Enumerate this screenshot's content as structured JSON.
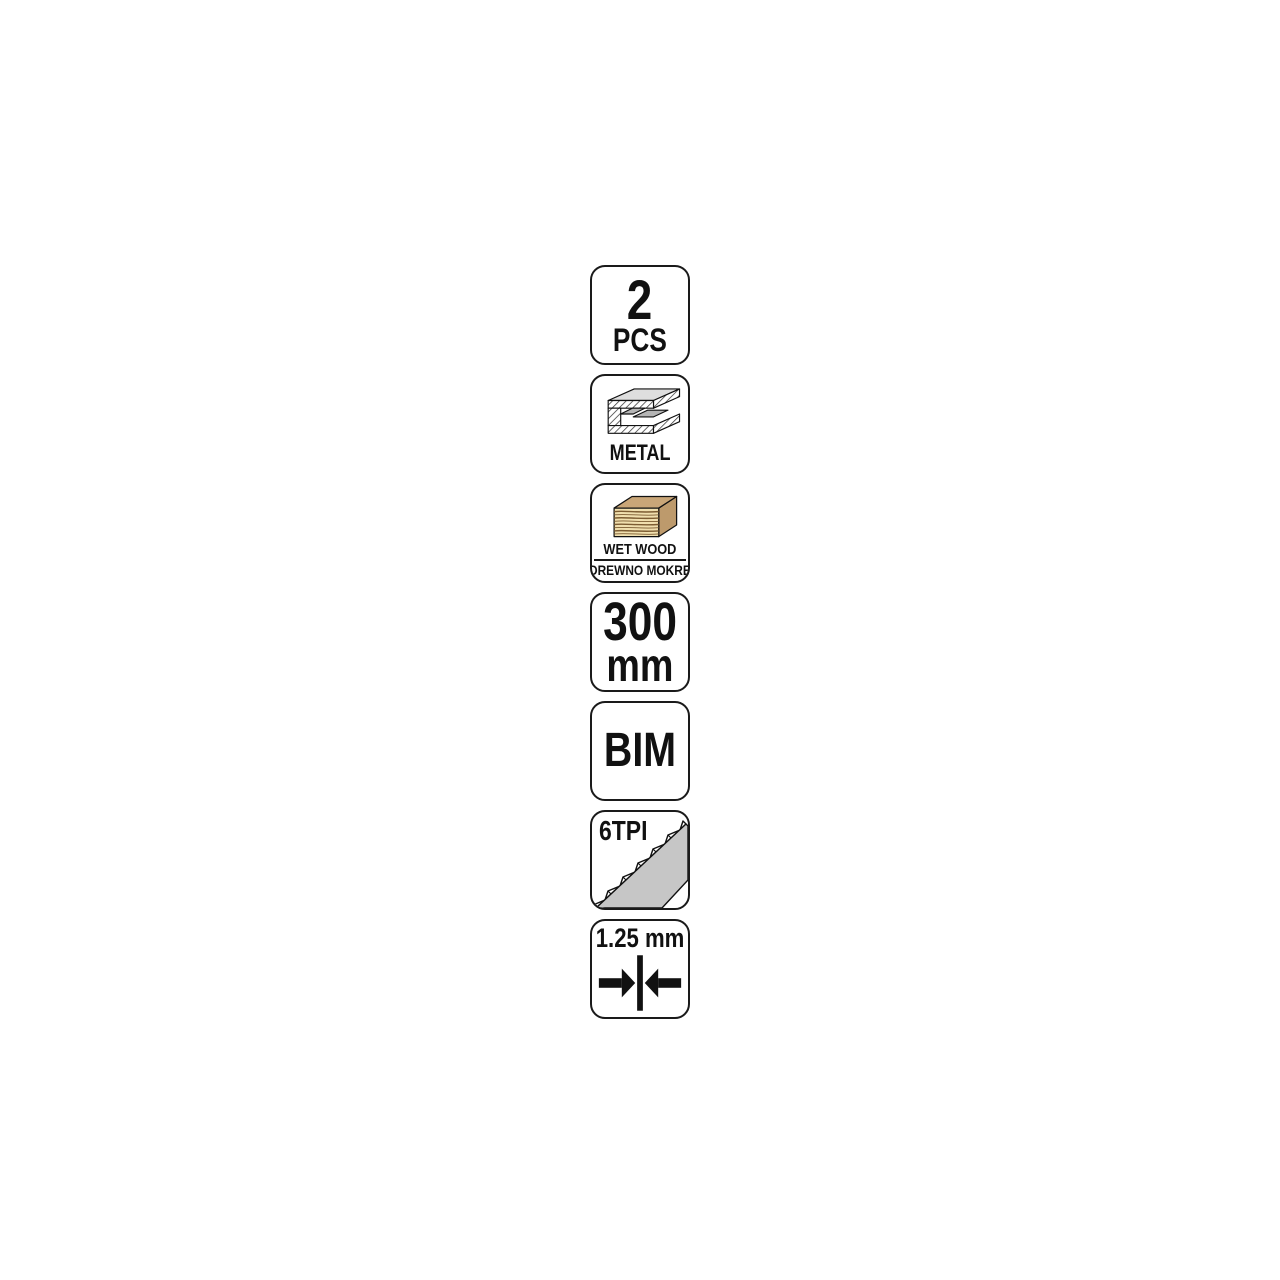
{
  "page": {
    "type": "product-feature-icon-strip",
    "background": "#ffffff"
  },
  "badges": {
    "quantity": {
      "value": "2",
      "unit": "PCS"
    },
    "metal": {
      "label": "METAL",
      "icon": "metal-profile-icon"
    },
    "wet_wood": {
      "label_en": "WET WOOD",
      "label_pl": "DREWNO MOKRE",
      "icon": "wood-beam-icon"
    },
    "length": {
      "value": "300",
      "unit": "mm"
    },
    "bimetal": {
      "value": "BIM"
    },
    "teeth": {
      "value": "6TPI",
      "icon": "saw-teeth-icon"
    },
    "thickness": {
      "value": "1.25 mm",
      "icon": "blade-thickness-icon"
    }
  },
  "colors": {
    "badge_border": "#1a1a1a",
    "text": "#111111",
    "metal_light_gray": "#dedede",
    "metal_mid_gray": "#b5b5b5",
    "wood_top": "#c9a678",
    "wood_side": "#bd9a6c",
    "wood_front": "#f0dfae",
    "wood_grain": "#7c5c32",
    "saw_body_gray": "#c6c6c6"
  }
}
